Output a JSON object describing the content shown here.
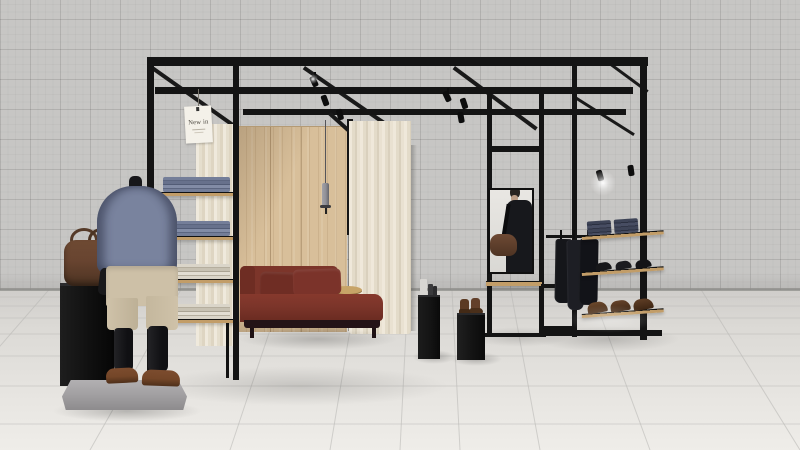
{
  "sign": {
    "label": "New in"
  },
  "scene": {
    "setting": "Minimalist pop-up menswear store: black steel frame pavilion with track spotlights, standing on a white tiled floor against a grey graph-grid wall",
    "objects": [
      "black-steel-frame-pavilion",
      "roof-joists-with-track-spotlights",
      "new-in-hang-tag",
      "left-shelving-unit-folded-knitwear",
      "headless-mannequin-blue-sweater-beige-shorts",
      "stone-slab-base",
      "black-plinth-with-leather-duffel-bag",
      "oak-wood-panel-wall",
      "grey-pendant-light",
      "rust-red-chaise-sofa-with-cushions",
      "round-wood-side-table",
      "cream-floor-curtain",
      "inner-cream-curtain",
      "black-plinth-grooming-products",
      "black-plinth-brown-boots",
      "mirror-reflecting-man-with-leather-bag",
      "wood-shelf-below-mirror",
      "clothing-rail-dark-coats",
      "tilted-shelf-folded-jeans",
      "tilted-shelf-black-shoes",
      "tilted-shelf-brown-shoes",
      "spotlight-glow"
    ]
  },
  "colors": {
    "wall": "#c7c6c4",
    "floor": "#e8e6e2",
    "floordark": "#cfcdca",
    "frame": "#141414",
    "wood": "#d8bf9a",
    "curtain": "#e7e0d0",
    "sofa": "#7c352a",
    "sofabase": "#241317",
    "knit": "#79839e",
    "shorts": "#cdc0a7",
    "body": "#17171a",
    "shoebrown": "#744628",
    "slab": "#a3a1a3",
    "plinth": "#131313",
    "bag": "#684430",
    "board": "#c29d68",
    "denim": "#3c4255",
    "boot": "#5b3a23",
    "coat": "#17181c",
    "mirrorbg": "#e9e7e3",
    "pendant": "#8f8f96",
    "tag": "#f4f1e9",
    "knitfolda": "#747e99",
    "knitfoldb": "#67718c",
    "creamfolda": "#dad5c9",
    "creamfoldb": "#c7c1b2"
  }
}
